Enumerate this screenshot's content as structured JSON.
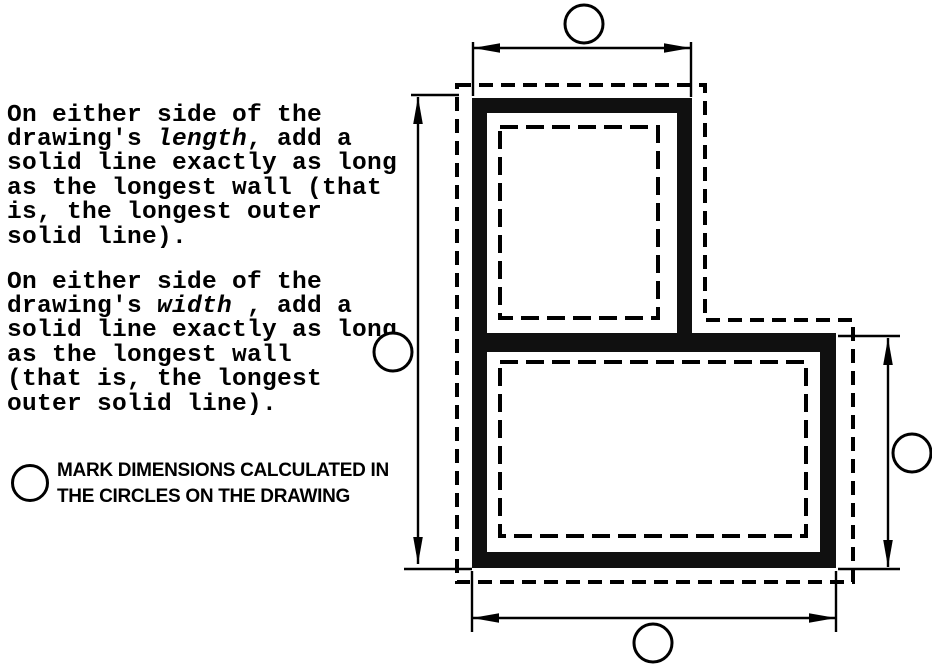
{
  "instructions": [
    {
      "pre": "On either side of the\ndrawing's ",
      "italic": "length",
      "post": ", add a\nsolid line exactly as long\nas the longest wall (that\nis, the longest outer\nsolid line)."
    },
    {
      "pre": "On either side of the\ndrawing's ",
      "italic": "width",
      "post": " , add a\nsolid line exactly as long\nas the longest wall\n(that is, the longest\nouter solid line)."
    }
  ],
  "legend": {
    "text": "MARK DIMENSIONS CALCULATED IN\nTHE CIRCLES ON THE DRAWING"
  },
  "colors": {
    "ink": "#000000",
    "wall": "#101010",
    "paper": "#ffffff"
  }
}
